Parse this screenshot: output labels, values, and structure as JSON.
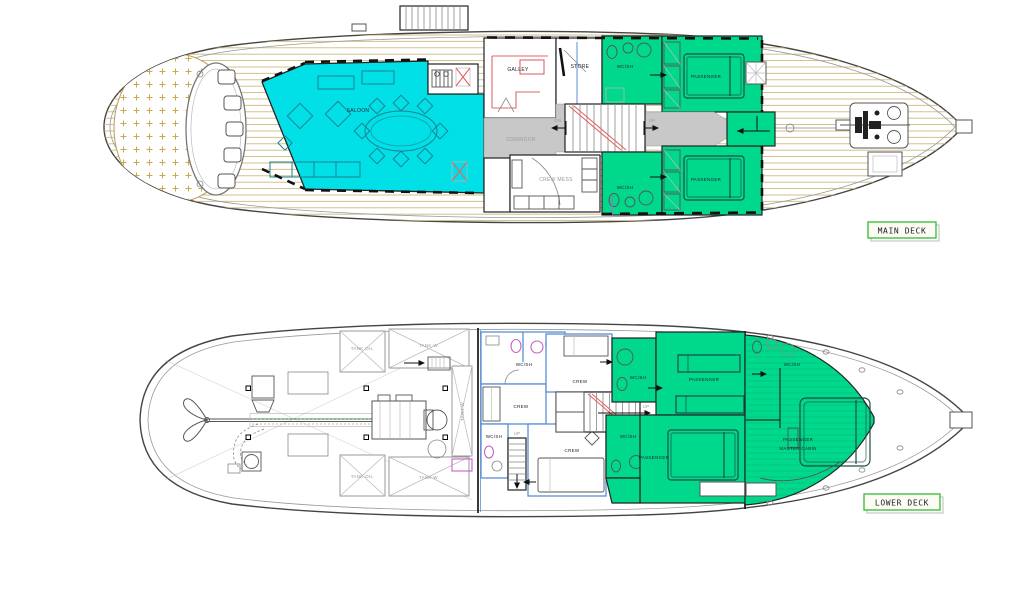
{
  "drawing": {
    "main_deck": {
      "badge": "MAIN DECK",
      "saloon": "SALOON",
      "galley": "GALLEY",
      "store": "STORE",
      "corridor": "CORRIDOR",
      "crew_mess": "CREW MESS"
    },
    "lower_deck": {
      "badge": "LOWER DECK",
      "master_cabin_line1": "PASSENGER",
      "master_cabin_line2": "MASTER CABIN"
    },
    "shared": {
      "wc_shower": "WC/SH",
      "crew": "CREW",
      "passenger": "PASSENGER",
      "up": "UP",
      "down": "DN",
      "tank_oil": "TANK OIL",
      "tank_water": "TANK W."
    },
    "colors": {
      "saloon_cyan": "#00E0E6",
      "cabin_green": "#00D98C",
      "deck_plank": "#CDB97E",
      "corridor_grey": "#C8C8C8",
      "wall_blue": "#5B8FD4",
      "accent_red": "#E06666",
      "fixture_magenta": "#C65FC6",
      "badge_green": "#33BB33"
    }
  }
}
